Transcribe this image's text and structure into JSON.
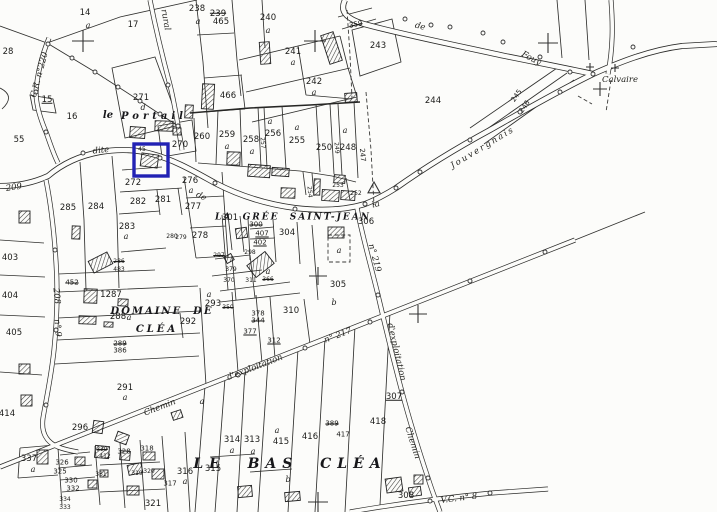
{
  "colors": {
    "ink": "#30302e",
    "paper": "#fcfcfa",
    "highlight": "#2222b4"
  },
  "highlight": {
    "x": 134,
    "y": 144,
    "w": 34,
    "h": 32
  },
  "labels": [
    {
      "t": "14",
      "x": 85,
      "y": 13,
      "c": "n"
    },
    {
      "t": "a",
      "x": 88,
      "y": 26,
      "c": "a"
    },
    {
      "t": "17",
      "x": 133,
      "y": 25,
      "c": "n"
    },
    {
      "t": "238",
      "x": 197,
      "y": 9,
      "c": "n"
    },
    {
      "t": "a",
      "x": 198,
      "y": 22,
      "c": "a"
    },
    {
      "t": "239",
      "x": 218,
      "y": 14,
      "c": "n k"
    },
    {
      "t": "465",
      "x": 221,
      "y": 22,
      "c": "n"
    },
    {
      "t": "240",
      "x": 268,
      "y": 18,
      "c": "n"
    },
    {
      "t": "a",
      "x": 268,
      "y": 31,
      "c": "a"
    },
    {
      "t": "359",
      "x": 356,
      "y": 25,
      "c": "s k",
      "r": -12
    },
    {
      "t": "241",
      "x": 293,
      "y": 52,
      "c": "n"
    },
    {
      "t": "a",
      "x": 293,
      "y": 63,
      "c": "a"
    },
    {
      "t": "242",
      "x": 314,
      "y": 82,
      "c": "n"
    },
    {
      "t": "a",
      "x": 314,
      "y": 93,
      "c": "a"
    },
    {
      "t": "243",
      "x": 378,
      "y": 46,
      "c": "n"
    },
    {
      "t": "244",
      "x": 433,
      "y": 101,
      "c": "n"
    },
    {
      "t": "245",
      "x": 517,
      "y": 96,
      "c": "s",
      "r": -55
    },
    {
      "t": "246",
      "x": 525,
      "y": 107,
      "c": "s",
      "r": -55
    },
    {
      "t": "28",
      "x": 8,
      "y": 52,
      "c": "n"
    },
    {
      "t": "15",
      "x": 47,
      "y": 100,
      "c": "n u"
    },
    {
      "t": "16",
      "x": 72,
      "y": 117,
      "c": "n"
    },
    {
      "t": "55",
      "x": 19,
      "y": 140,
      "c": "n"
    },
    {
      "t": "271",
      "x": 141,
      "y": 98,
      "c": "n"
    },
    {
      "t": "d",
      "x": 143,
      "y": 108,
      "c": "a"
    },
    {
      "t": "270",
      "x": 180,
      "y": 145,
      "c": "n"
    },
    {
      "t": "466",
      "x": 228,
      "y": 96,
      "c": "n"
    },
    {
      "t": "260",
      "x": 202,
      "y": 137,
      "c": "n"
    },
    {
      "t": "259",
      "x": 227,
      "y": 135,
      "c": "n"
    },
    {
      "t": "a",
      "x": 227,
      "y": 147,
      "c": "a"
    },
    {
      "t": "258",
      "x": 251,
      "y": 140,
      "c": "n"
    },
    {
      "t": "a",
      "x": 252,
      "y": 152,
      "c": "a"
    },
    {
      "t": "257",
      "x": 262,
      "y": 143,
      "c": "t",
      "r": 85
    },
    {
      "t": "256",
      "x": 273,
      "y": 134,
      "c": "n"
    },
    {
      "t": "a",
      "x": 270,
      "y": 122,
      "c": "a"
    },
    {
      "t": "255",
      "x": 297,
      "y": 141,
      "c": "n"
    },
    {
      "t": "a",
      "x": 297,
      "y": 128,
      "c": "a"
    },
    {
      "t": "250",
      "x": 324,
      "y": 148,
      "c": "n"
    },
    {
      "t": "249",
      "x": 336,
      "y": 148,
      "c": "t",
      "r": 85
    },
    {
      "t": "248",
      "x": 348,
      "y": 148,
      "c": "n"
    },
    {
      "t": "a",
      "x": 345,
      "y": 131,
      "c": "a"
    },
    {
      "t": "247",
      "x": 362,
      "y": 155,
      "c": "s",
      "r": 85
    },
    {
      "t": "254",
      "x": 309,
      "y": 192,
      "c": "t",
      "r": 85
    },
    {
      "t": "253",
      "x": 338,
      "y": 186,
      "c": "t"
    },
    {
      "t": "252",
      "x": 356,
      "y": 194,
      "c": "t"
    },
    {
      "t": "45",
      "x": 142,
      "y": 150,
      "c": "t"
    },
    {
      "t": "272",
      "x": 133,
      "y": 183,
      "c": "n"
    },
    {
      "t": "282",
      "x": 138,
      "y": 202,
      "c": "n"
    },
    {
      "t": "281",
      "x": 163,
      "y": 200,
      "c": "n"
    },
    {
      "t": "283",
      "x": 127,
      "y": 227,
      "c": "n"
    },
    {
      "t": "a",
      "x": 126,
      "y": 237,
      "c": "a"
    },
    {
      "t": "284",
      "x": 96,
      "y": 207,
      "c": "n"
    },
    {
      "t": "285",
      "x": 68,
      "y": 208,
      "c": "n"
    },
    {
      "t": "276",
      "x": 190,
      "y": 181,
      "c": "n"
    },
    {
      "t": "a",
      "x": 191,
      "y": 191,
      "c": "a"
    },
    {
      "t": "277",
      "x": 193,
      "y": 207,
      "c": "n"
    },
    {
      "t": "278",
      "x": 200,
      "y": 236,
      "c": "n"
    },
    {
      "t": "280",
      "x": 172,
      "y": 237,
      "c": "t"
    },
    {
      "t": "279",
      "x": 181,
      "y": 238,
      "c": "t"
    },
    {
      "t": "301",
      "x": 230,
      "y": 218,
      "c": "n"
    },
    {
      "t": "300",
      "x": 256,
      "y": 225,
      "c": "s k"
    },
    {
      "t": "407",
      "x": 262,
      "y": 234,
      "c": "s u"
    },
    {
      "t": "304",
      "x": 287,
      "y": 233,
      "c": "n"
    },
    {
      "t": "402",
      "x": 260,
      "y": 243,
      "c": "s u"
    },
    {
      "t": "297",
      "x": 219,
      "y": 256,
      "c": "t k"
    },
    {
      "t": "298",
      "x": 250,
      "y": 253,
      "c": "t"
    },
    {
      "t": "379",
      "x": 231,
      "y": 270,
      "c": "t"
    },
    {
      "t": "a",
      "x": 268,
      "y": 272,
      "c": "a"
    },
    {
      "t": "370",
      "x": 229,
      "y": 281,
      "c": "t"
    },
    {
      "t": "311",
      "x": 251,
      "y": 281,
      "c": "t"
    },
    {
      "t": "366",
      "x": 268,
      "y": 280,
      "c": "t k"
    },
    {
      "t": "350",
      "x": 228,
      "y": 308,
      "c": "t k"
    },
    {
      "t": "378",
      "x": 258,
      "y": 314,
      "c": "s"
    },
    {
      "t": "344",
      "x": 258,
      "y": 321,
      "c": "s k"
    },
    {
      "t": "377",
      "x": 250,
      "y": 332,
      "c": "s u"
    },
    {
      "t": "312",
      "x": 274,
      "y": 341,
      "c": "s u"
    },
    {
      "t": "310",
      "x": 291,
      "y": 311,
      "c": "n"
    },
    {
      "t": "b",
      "x": 334,
      "y": 303,
      "c": "a"
    },
    {
      "t": "293",
      "x": 213,
      "y": 304,
      "c": "n"
    },
    {
      "t": "a",
      "x": 209,
      "y": 295,
      "c": "a"
    },
    {
      "t": "305",
      "x": 338,
      "y": 285,
      "c": "n"
    },
    {
      "t": "a",
      "x": 339,
      "y": 251,
      "c": "a"
    },
    {
      "t": "306",
      "x": 366,
      "y": 222,
      "c": "n"
    },
    {
      "t": "307",
      "x": 394,
      "y": 397,
      "c": "n u"
    },
    {
      "t": "308",
      "x": 406,
      "y": 496,
      "c": "n"
    },
    {
      "t": "1287",
      "x": 111,
      "y": 295,
      "c": "n"
    },
    {
      "t": "288",
      "x": 118,
      "y": 317,
      "c": "n"
    },
    {
      "t": "a",
      "x": 129,
      "y": 318,
      "c": "a"
    },
    {
      "t": "292",
      "x": 188,
      "y": 322,
      "c": "n"
    },
    {
      "t": "289",
      "x": 120,
      "y": 344,
      "c": "s k"
    },
    {
      "t": "386",
      "x": 120,
      "y": 351,
      "c": "s"
    },
    {
      "t": "291",
      "x": 125,
      "y": 388,
      "c": "n"
    },
    {
      "t": "a",
      "x": 125,
      "y": 398,
      "c": "a"
    },
    {
      "t": "452",
      "x": 72,
      "y": 283,
      "c": "s k"
    },
    {
      "t": "286",
      "x": 119,
      "y": 262,
      "c": "t k"
    },
    {
      "t": "483",
      "x": 119,
      "y": 270,
      "c": "t"
    },
    {
      "t": "403",
      "x": 10,
      "y": 258,
      "c": "n"
    },
    {
      "t": "404",
      "x": 10,
      "y": 296,
      "c": "n"
    },
    {
      "t": "405",
      "x": 14,
      "y": 333,
      "c": "n"
    },
    {
      "t": "414",
      "x": 7,
      "y": 414,
      "c": "n"
    },
    {
      "t": "208",
      "x": 56,
      "y": 296,
      "c": "s rd",
      "r": 85
    },
    {
      "t": "209",
      "x": 14,
      "y": 188,
      "c": "s rd",
      "r": -8
    },
    {
      "t": "n° 9",
      "x": 57,
      "y": 328,
      "c": "t rd",
      "r": 85
    },
    {
      "t": "296",
      "x": 80,
      "y": 428,
      "c": "n"
    },
    {
      "t": "337",
      "x": 29,
      "y": 459,
      "c": "n"
    },
    {
      "t": "a",
      "x": 33,
      "y": 470,
      "c": "a"
    },
    {
      "t": "326",
      "x": 62,
      "y": 463,
      "c": "s"
    },
    {
      "t": "325",
      "x": 60,
      "y": 472,
      "c": "s"
    },
    {
      "t": "330",
      "x": 71,
      "y": 481,
      "c": "s"
    },
    {
      "t": "332",
      "x": 73,
      "y": 489,
      "c": "s"
    },
    {
      "t": "334",
      "x": 65,
      "y": 500,
      "c": "t"
    },
    {
      "t": "333",
      "x": 65,
      "y": 508,
      "c": "t"
    },
    {
      "t": "329",
      "x": 102,
      "y": 450,
      "c": "t k"
    },
    {
      "t": "412",
      "x": 105,
      "y": 457,
      "c": "t"
    },
    {
      "t": "328",
      "x": 124,
      "y": 452,
      "c": "s"
    },
    {
      "t": "318",
      "x": 147,
      "y": 449,
      "c": "s"
    },
    {
      "t": "331",
      "x": 101,
      "y": 475,
      "c": "t"
    },
    {
      "t": "319",
      "x": 137,
      "y": 474,
      "c": "t"
    },
    {
      "t": "320",
      "x": 149,
      "y": 472,
      "c": "t"
    },
    {
      "t": "321",
      "x": 153,
      "y": 504,
      "c": "n"
    },
    {
      "t": "317",
      "x": 170,
      "y": 484,
      "c": "s"
    },
    {
      "t": "316",
      "x": 185,
      "y": 472,
      "c": "n"
    },
    {
      "t": "a",
      "x": 185,
      "y": 482,
      "c": "a"
    },
    {
      "t": "315",
      "x": 213,
      "y": 469,
      "c": "n"
    },
    {
      "t": "a",
      "x": 202,
      "y": 402,
      "c": "a"
    },
    {
      "t": "314",
      "x": 232,
      "y": 440,
      "c": "n"
    },
    {
      "t": "a",
      "x": 232,
      "y": 451,
      "c": "a"
    },
    {
      "t": "313",
      "x": 252,
      "y": 440,
      "c": "n"
    },
    {
      "t": "a",
      "x": 253,
      "y": 452,
      "c": "a"
    },
    {
      "t": "415",
      "x": 281,
      "y": 442,
      "c": "n"
    },
    {
      "t": "a",
      "x": 277,
      "y": 431,
      "c": "a"
    },
    {
      "t": "b",
      "x": 288,
      "y": 480,
      "c": "a"
    },
    {
      "t": "416",
      "x": 310,
      "y": 437,
      "c": "n"
    },
    {
      "t": "389",
      "x": 332,
      "y": 424,
      "c": "s k"
    },
    {
      "t": "417",
      "x": 343,
      "y": 435,
      "c": "s"
    },
    {
      "t": "418",
      "x": 378,
      "y": 422,
      "c": "n"
    },
    {
      "t": "le",
      "x": 108,
      "y": 116,
      "c": "nm md"
    },
    {
      "t": "Portail",
      "x": 154,
      "y": 117,
      "c": "nm md",
      "ls": 4
    },
    {
      "t": "LA  GRÉE  SAINT-JEAN",
      "x": 293,
      "y": 218,
      "c": "nm sm8",
      "ls": 2
    },
    {
      "t": "DOMAINE  DE",
      "x": 162,
      "y": 312,
      "c": "nm md",
      "ls": 2
    },
    {
      "t": "CLÉA",
      "x": 157,
      "y": 330,
      "c": "nm md",
      "ls": 3
    },
    {
      "t": "LE  BAS  CLÉA",
      "x": 290,
      "y": 464,
      "c": "nm lg",
      "ls": 6
    },
    {
      "t": "Calvaire",
      "x": 620,
      "y": 80,
      "c": "rd"
    },
    {
      "t": "dite",
      "x": 101,
      "y": 151,
      "c": "rd",
      "r": -6
    },
    {
      "t": "de",
      "x": 201,
      "y": 197,
      "c": "rd",
      "r": 27
    },
    {
      "t": "la",
      "x": 376,
      "y": 205,
      "c": "rd",
      "r": -14
    },
    {
      "t": "de",
      "x": 420,
      "y": 27,
      "c": "rd",
      "r": 14
    },
    {
      "t": "Fouy",
      "x": 531,
      "y": 59,
      "c": "rd",
      "r": 28
    },
    {
      "t": "Jouvergnais",
      "x": 483,
      "y": 148,
      "c": "rd",
      "r": -31,
      "ls": 2
    },
    {
      "t": "rural",
      "x": 165,
      "y": 20,
      "c": "rd",
      "r": 80
    },
    {
      "t": "C.R. n°220",
      "x": 40,
      "y": 75,
      "c": "rd s",
      "r": -75
    },
    {
      "t": "Chemin",
      "x": 160,
      "y": 408,
      "c": "rd",
      "r": -21
    },
    {
      "t": "d'exploitation",
      "x": 255,
      "y": 368,
      "c": "rd",
      "r": -21
    },
    {
      "t": "n° 217",
      "x": 338,
      "y": 336,
      "c": "rd",
      "r": -21
    },
    {
      "t": "n° 219",
      "x": 374,
      "y": 258,
      "c": "rd",
      "r": 75
    },
    {
      "t": "d'exploitation",
      "x": 396,
      "y": 352,
      "c": "rd",
      "r": 77
    },
    {
      "t": "Chemin",
      "x": 412,
      "y": 443,
      "c": "rd",
      "r": 72
    },
    {
      "t": "V.C. n° 8",
      "x": 459,
      "y": 499,
      "c": "rd",
      "r": -7
    }
  ],
  "buildings": [
    [
      202,
      84,
      12,
      25,
      3
    ],
    [
      260,
      42,
      10,
      22,
      -4
    ],
    [
      325,
      33,
      13,
      30,
      -18
    ],
    [
      345,
      93,
      12,
      9,
      -4
    ],
    [
      130,
      127,
      15,
      11,
      4
    ],
    [
      155,
      121,
      18,
      10,
      2
    ],
    [
      173,
      128,
      8,
      7,
      0
    ],
    [
      185,
      105,
      8,
      13,
      3
    ],
    [
      141,
      154,
      17,
      13,
      8
    ],
    [
      227,
      152,
      13,
      13,
      2
    ],
    [
      248,
      165,
      22,
      12,
      4
    ],
    [
      272,
      168,
      17,
      8,
      4
    ],
    [
      281,
      188,
      14,
      10,
      2
    ],
    [
      314,
      179,
      6,
      16,
      2
    ],
    [
      322,
      190,
      17,
      11,
      4
    ],
    [
      341,
      191,
      14,
      9,
      4
    ],
    [
      334,
      175,
      11,
      8,
      4
    ],
    [
      328,
      227,
      16,
      11,
      0
    ],
    [
      236,
      228,
      11,
      10,
      -8
    ],
    [
      225,
      255,
      8,
      7,
      -30
    ],
    [
      249,
      257,
      23,
      15,
      -38
    ],
    [
      90,
      256,
      21,
      13,
      -27
    ],
    [
      19,
      211,
      11,
      12,
      0
    ],
    [
      72,
      226,
      8,
      13,
      2
    ],
    [
      84,
      289,
      13,
      14,
      2
    ],
    [
      118,
      299,
      10,
      7,
      3
    ],
    [
      79,
      316,
      17,
      8,
      2
    ],
    [
      104,
      322,
      9,
      5,
      2
    ],
    [
      19,
      364,
      11,
      10,
      0
    ],
    [
      21,
      395,
      11,
      11,
      0
    ],
    [
      93,
      421,
      10,
      12,
      8
    ],
    [
      172,
      411,
      10,
      8,
      -18
    ],
    [
      116,
      433,
      12,
      10,
      20
    ],
    [
      95,
      446,
      14,
      12,
      5
    ],
    [
      120,
      451,
      10,
      9,
      5
    ],
    [
      143,
      452,
      12,
      8,
      0
    ],
    [
      152,
      469,
      12,
      10,
      0
    ],
    [
      75,
      457,
      10,
      8,
      0
    ],
    [
      128,
      464,
      14,
      10,
      -12
    ],
    [
      127,
      486,
      12,
      9,
      0
    ],
    [
      100,
      470,
      8,
      7,
      0
    ],
    [
      88,
      480,
      9,
      8,
      0
    ],
    [
      37,
      450,
      11,
      14,
      0
    ],
    [
      238,
      486,
      14,
      11,
      -5
    ],
    [
      285,
      492,
      15,
      9,
      -5
    ],
    [
      386,
      478,
      16,
      14,
      -8
    ],
    [
      409,
      487,
      12,
      9,
      -8
    ],
    [
      414,
      475,
      9,
      9,
      0
    ]
  ],
  "symbols": {
    "crosses": [
      [
        83,
        41,
        11
      ],
      [
        315,
        41,
        11
      ],
      [
        548,
        43,
        10
      ],
      [
        600,
        89,
        7
      ],
      [
        590,
        67,
        4
      ],
      [
        615,
        68,
        4
      ],
      [
        318,
        276,
        9
      ],
      [
        418,
        314,
        9
      ],
      [
        318,
        502,
        10
      ]
    ],
    "triangle": {
      "x": 374,
      "y": 188,
      "s": 6
    },
    "circles": [
      [
        48,
        44
      ],
      [
        72,
        58
      ],
      [
        95,
        72
      ],
      [
        118,
        87
      ],
      [
        140,
        101
      ],
      [
        160,
        114
      ],
      [
        178,
        126
      ],
      [
        405,
        19
      ],
      [
        431,
        25
      ],
      [
        450,
        27
      ],
      [
        483,
        33
      ],
      [
        503,
        42
      ],
      [
        540,
        57
      ],
      [
        83,
        153
      ],
      [
        160,
        158
      ],
      [
        215,
        183
      ],
      [
        295,
        209
      ],
      [
        365,
        204
      ],
      [
        420,
        172
      ],
      [
        470,
        140
      ],
      [
        520,
        112
      ],
      [
        560,
        92
      ],
      [
        378,
        295
      ],
      [
        402,
        392
      ],
      [
        428,
        478
      ],
      [
        238,
        375
      ],
      [
        305,
        348
      ],
      [
        370,
        322
      ],
      [
        470,
        281
      ],
      [
        545,
        252
      ],
      [
        55,
        250
      ],
      [
        56,
        330
      ],
      [
        46,
        405
      ],
      [
        36,
        92
      ],
      [
        46,
        132
      ],
      [
        168,
        85
      ],
      [
        430,
        501
      ],
      [
        490,
        493
      ],
      [
        593,
        74
      ],
      [
        396,
        188
      ],
      [
        570,
        72
      ],
      [
        633,
        47
      ]
    ]
  }
}
